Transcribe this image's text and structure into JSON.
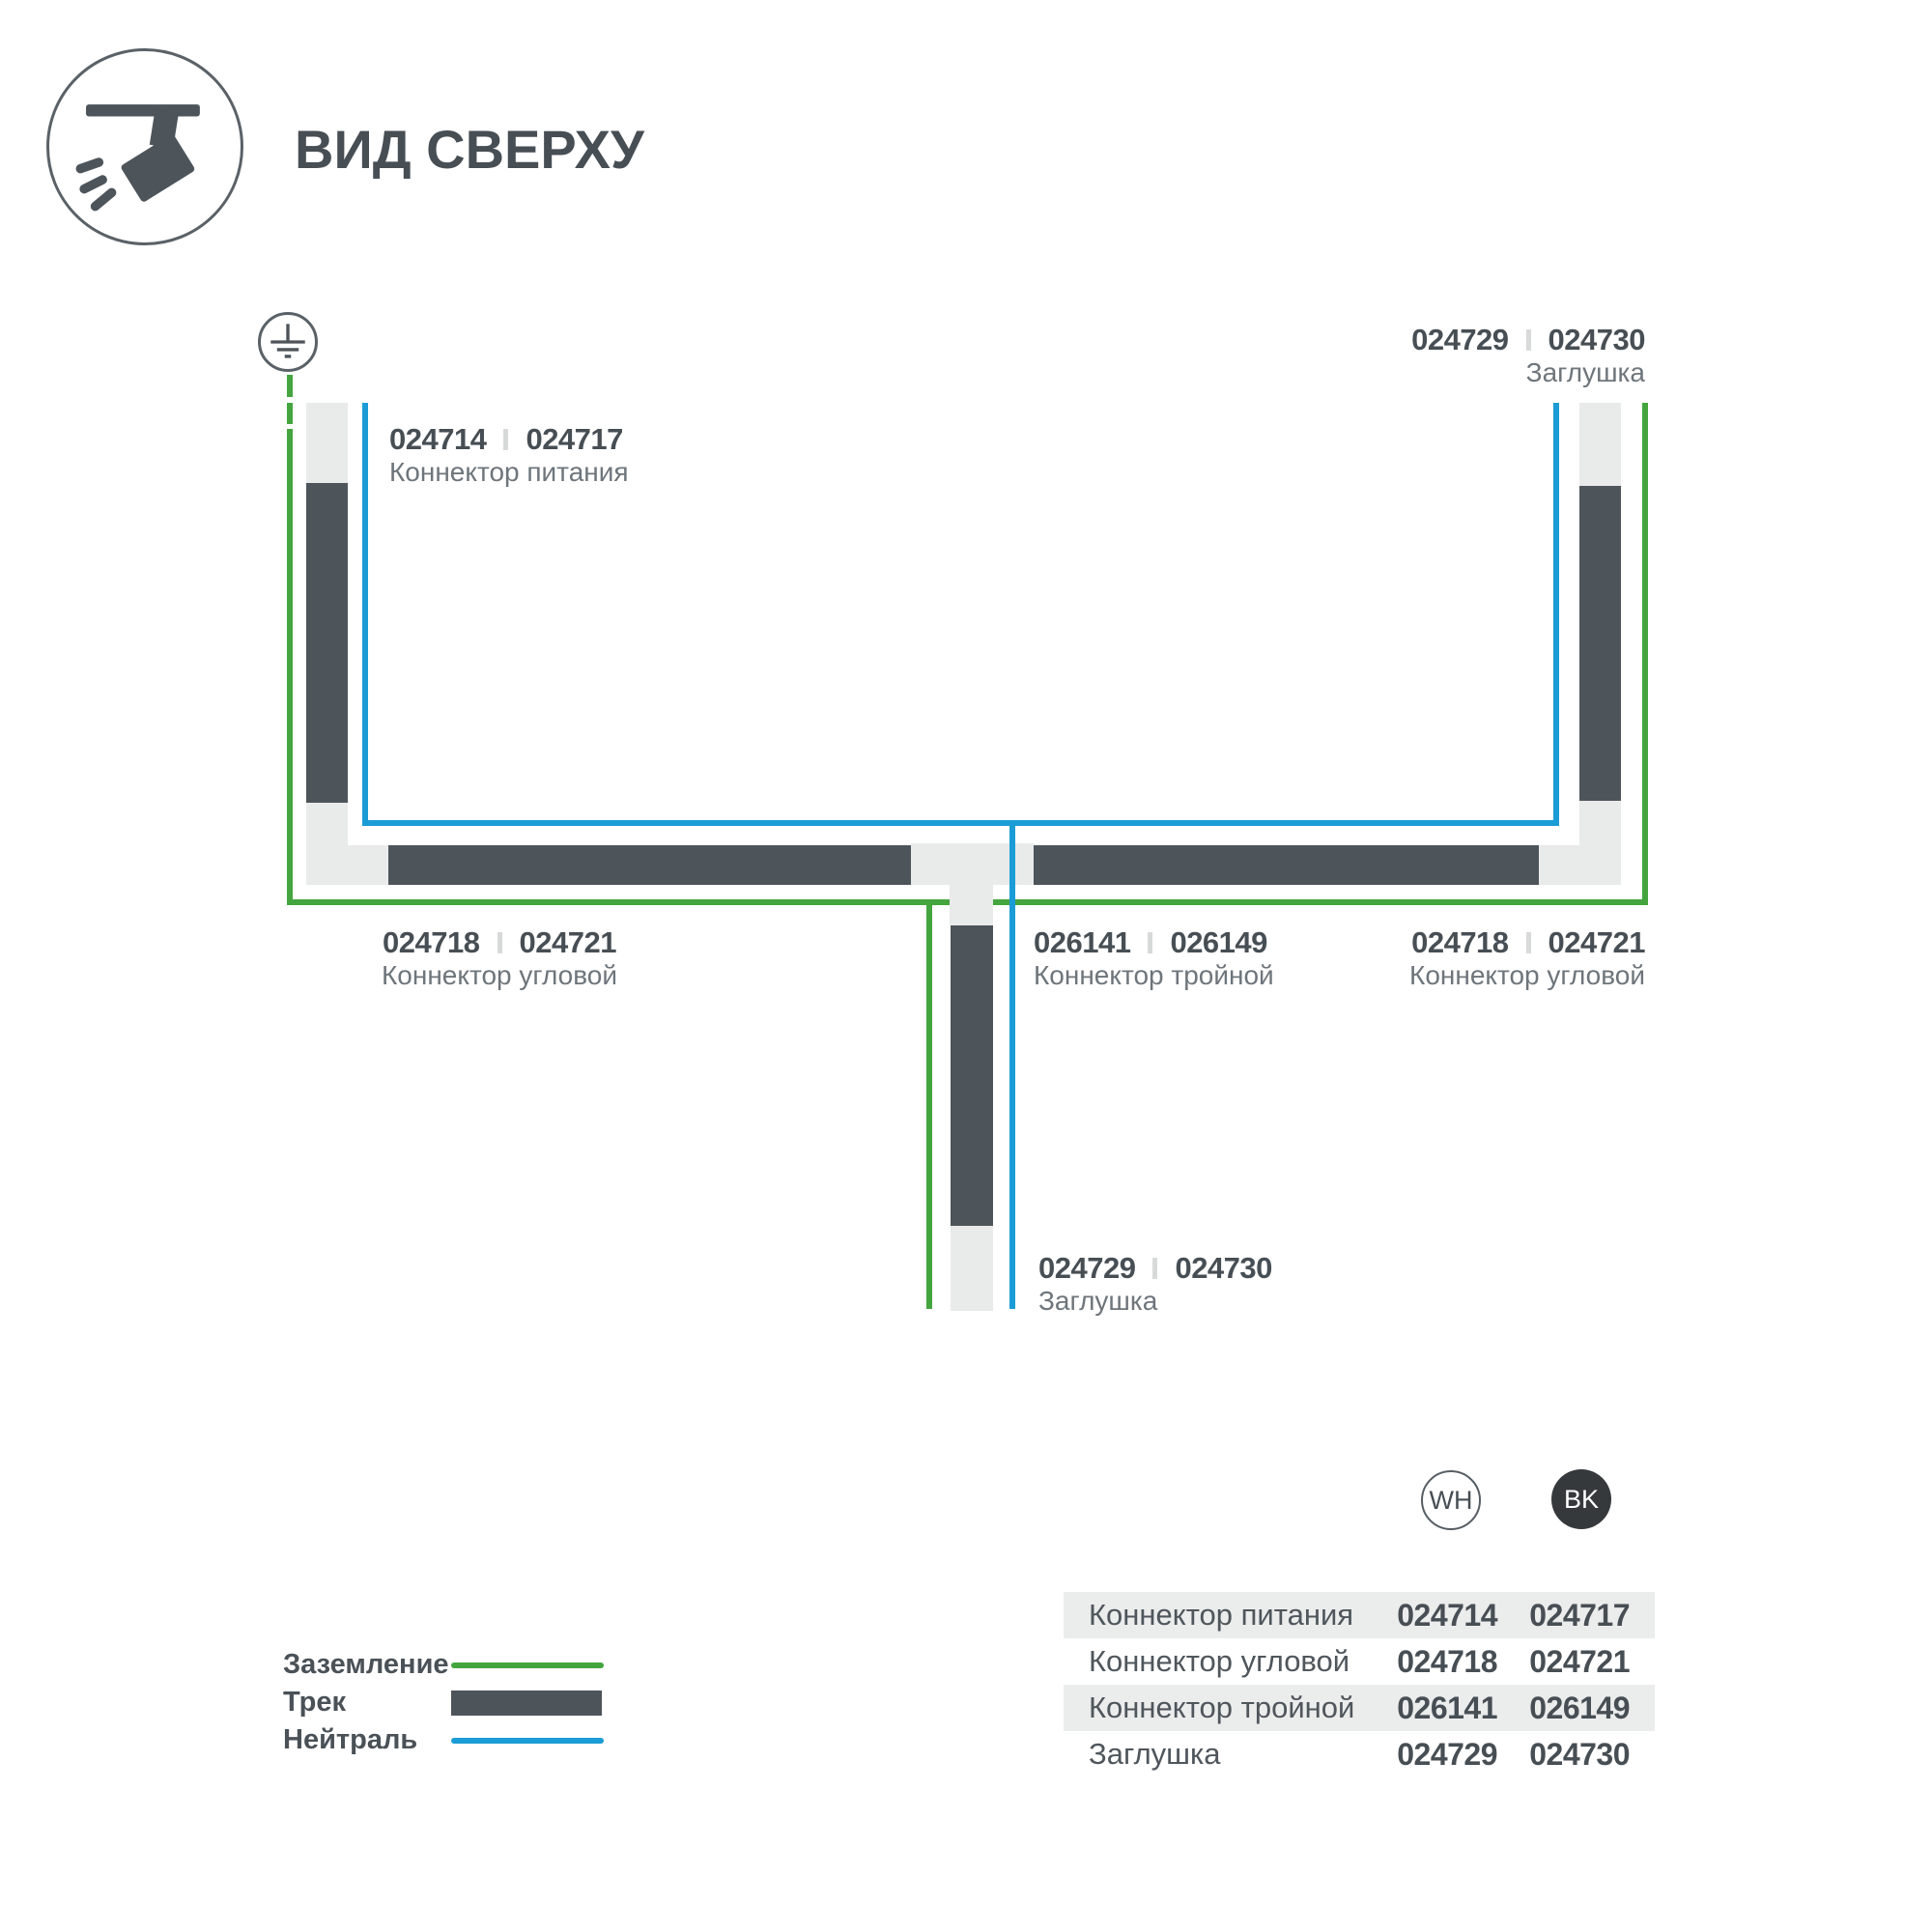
{
  "header": {
    "title": "ВИД СВЕРХУ"
  },
  "colors": {
    "track": "#4d545a",
    "connector": "#e9eaea",
    "ground_green": "#44a53e",
    "neutral_blue": "#1b9cd6",
    "text_primary": "#474e54",
    "text_secondary": "#6e757b",
    "divider": "#d8dada",
    "table_row_alt": "#ebecec",
    "badge_black": "#35393c"
  },
  "diagram": {
    "labels": {
      "power": {
        "wh": "024714",
        "bk": "024717",
        "name": "Коннектор питания"
      },
      "cap_top": {
        "wh": "024729",
        "bk": "024730",
        "name": "Заглушка"
      },
      "corner_l": {
        "wh": "024718",
        "bk": "024721",
        "name": "Коннектор угловой"
      },
      "triple": {
        "wh": "026141",
        "bk": "026149",
        "name": "Коннектор тройной"
      },
      "corner_r": {
        "wh": "024718",
        "bk": "024721",
        "name": "Коннектор угловой"
      },
      "cap_bottom": {
        "wh": "024729",
        "bk": "024730",
        "name": "Заглушка"
      }
    }
  },
  "variants": {
    "white": "WH",
    "black": "BK"
  },
  "legend": {
    "ground": "Заземление",
    "track": "Трек",
    "neutral": "Нейтраль"
  },
  "table": {
    "rows": [
      {
        "name": "Коннектор питания",
        "wh": "024714",
        "bk": "024717"
      },
      {
        "name": "Коннектор угловой",
        "wh": "024718",
        "bk": "024721"
      },
      {
        "name": "Коннектор тройной",
        "wh": "026141",
        "bk": "026149"
      },
      {
        "name": "Заглушка",
        "wh": "024729",
        "bk": "024730"
      }
    ]
  }
}
